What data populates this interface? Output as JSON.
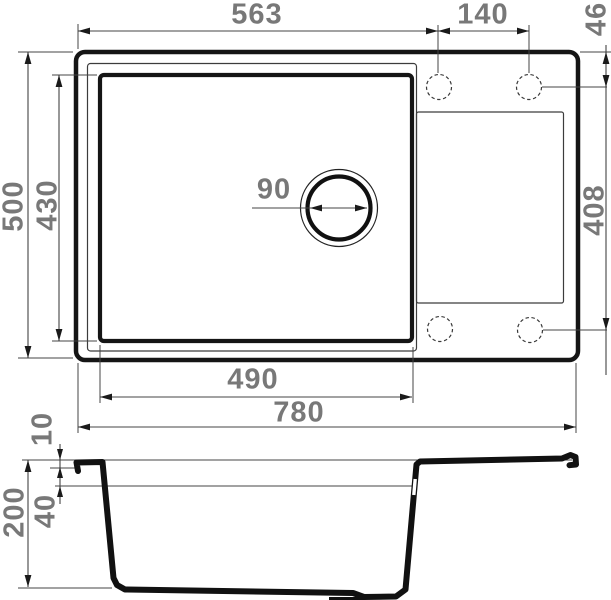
{
  "top_view": {
    "top_width": "563",
    "hole_spacing": "140",
    "hole_top_offset": "46",
    "overall_depth": "500",
    "bowl_depth": "430",
    "drain_diameter": "90",
    "hole_row_span": "408",
    "bowl_width": "490",
    "overall_width": "780"
  },
  "section_view": {
    "rim_height": "10",
    "total_height": "200",
    "ledge_depth": "40"
  },
  "colors": {
    "outline": "#151515",
    "thin_line": "#3c3c3c",
    "dimension_line": "#444444",
    "label_text": "#787878",
    "background": "#ffffff"
  }
}
